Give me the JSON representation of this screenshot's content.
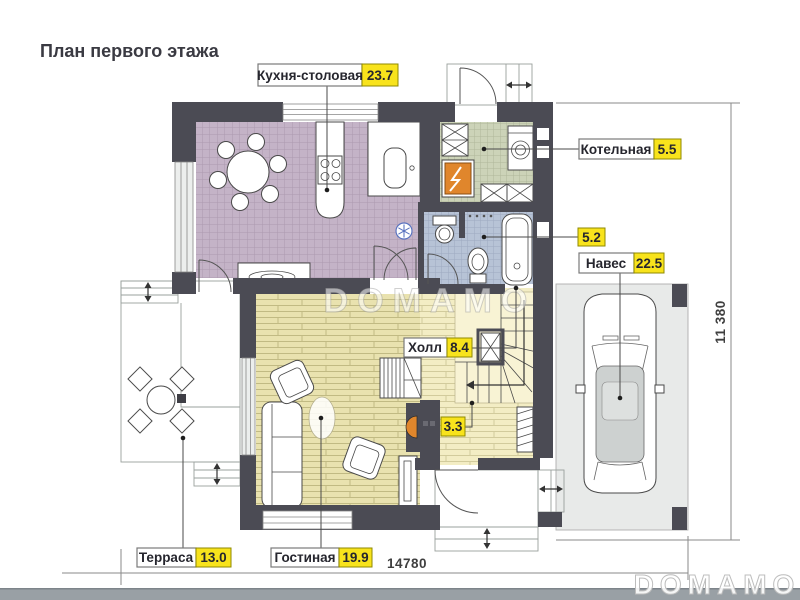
{
  "title": "План первого этажа",
  "rooms": [
    {
      "label": "Кухня-столовая",
      "area": "23.7"
    },
    {
      "label": "Котельная",
      "area": "5.5"
    },
    {
      "label": "",
      "area": "5.2"
    },
    {
      "label": "Навес",
      "area": "22.5"
    },
    {
      "label": "Холл",
      "area": "8.4"
    },
    {
      "label": "",
      "area": "3.3"
    },
    {
      "label": "Терраса",
      "area": "13.0"
    },
    {
      "label": "Гостиная",
      "area": "19.9"
    }
  ],
  "dimensions": {
    "width": "14780",
    "height": "11 380"
  },
  "watermark": {
    "center": "DOMAMO",
    "corner": "DOMAMO"
  },
  "colors": {
    "wall": "#4b4b54",
    "area_badge": "#f8e31c",
    "kitchen_floor": "#c4b3c7",
    "boiler_floor": "#ccd3b8",
    "bath_floor": "#b7c3d6",
    "hall_floor": "#f3edc4",
    "living_floor": "#e9e2af",
    "stairs_floor": "#f8f3d4",
    "terrace_floor": "#e4e6e5",
    "carport_floor": "#e8eae9",
    "boiler_accent": "#e0862c",
    "fireplace_accent": "#e0862c"
  }
}
